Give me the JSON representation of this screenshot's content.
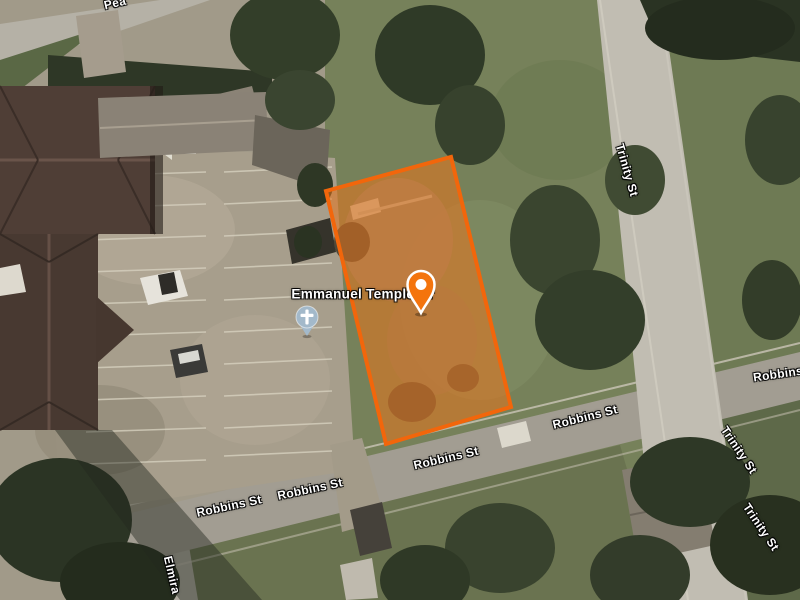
{
  "map": {
    "view": "satellite",
    "poi": {
      "name": "Emmanuel Temple Or",
      "icon": "church-cross",
      "icon_color": "#A3B9CA"
    },
    "marker": {
      "icon": "location-pin",
      "color": "#F4740D",
      "inner_color": "#FFFFFF"
    },
    "parcel": {
      "fill_color": "#E8741C",
      "fill_opacity": "0.55",
      "stroke_color": "#F2660B"
    },
    "streets": {
      "pea_partial": "Pea",
      "trinity_top": "Trinity St",
      "trinity_right_upper": "Trinity St",
      "trinity_right_lower": "Trinity St",
      "robbins_east": "Robbins St",
      "robbins_center": "Robbins St",
      "robbins_west_outer": "Robbins St",
      "robbins_west_inner": "Robbins St",
      "robbins_right_edge": "Robbins",
      "elmira": "Elmira"
    }
  }
}
